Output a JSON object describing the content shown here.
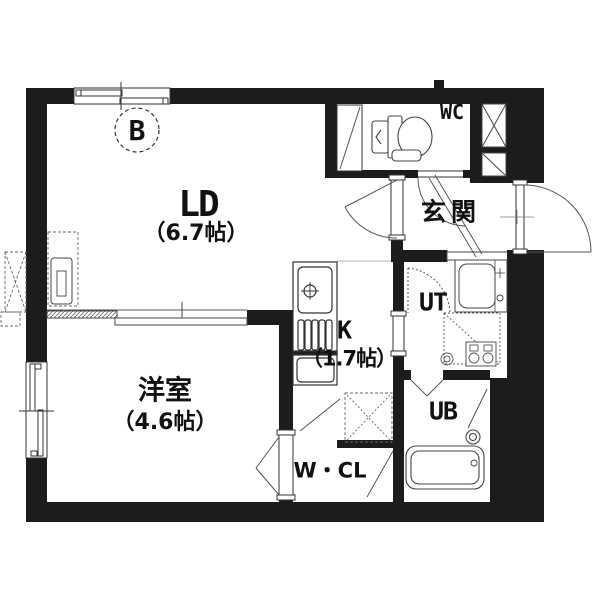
{
  "floorplan": {
    "balcony_marker": "B",
    "rooms": {
      "ld": {
        "label": "LD",
        "area": "（6.7帖）"
      },
      "western_room": {
        "label": "洋室",
        "area": "（4.6帖）"
      },
      "kitchen": {
        "label": "K",
        "area": "（1.7帖）"
      },
      "entrance": {
        "label": "玄関"
      },
      "toilet": {
        "label": "WC"
      },
      "utility": {
        "label": "UT"
      },
      "bath": {
        "label": "UB"
      },
      "closet": {
        "label": "W・CL"
      }
    }
  }
}
